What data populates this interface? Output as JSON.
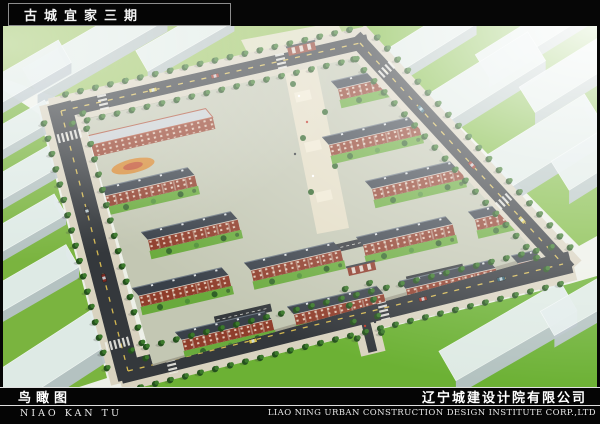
{
  "frame": {
    "title": "古城宜家三期"
  },
  "footer": {
    "caption_cn": "鸟瞰图",
    "caption_pinyin": "NIAO KAN TU",
    "company_cn": "辽宁城建设计院有限公司",
    "company_en": "LIAO NING URBAN CONSTRUCTION DESIGN INSTITUTE CORP.,LTD"
  },
  "scene": {
    "colors": {
      "base": "#edf0e8",
      "road": "#34383c",
      "sidewalk": "#d9d3c0",
      "dash": "#d4b851",
      "site": "#c3c7b3",
      "brick": "#8f3d2b",
      "roof": "#394049",
      "yard": "#69aa3c",
      "block_top": "#e3edec",
      "block_front": "#b7c3c8",
      "block_end": "#a7b3b8",
      "grass_bright": "#7db93e",
      "plaza": "#e5ddc5"
    },
    "ring": {
      "edges": [
        {
          "p1": [
            58,
            85
          ],
          "p2": [
            357,
            17
          ],
          "w": 14
        },
        {
          "p1": [
            357,
            17
          ],
          "p2": [
            560,
            238
          ],
          "w": 16
        },
        {
          "p1": [
            125,
            345
          ],
          "p2": [
            560,
            238
          ],
          "w": 22
        },
        {
          "p1": [
            58,
            85
          ],
          "p2": [
            125,
            345
          ],
          "w": 24
        },
        {
          "p1": [
            352,
            252
          ],
          "p2": [
            368,
            318
          ],
          "w": 9
        }
      ]
    },
    "site_clip": [
      [
        81,
        93
      ],
      [
        350,
        32
      ],
      [
        538,
        232
      ],
      [
        150,
        340
      ]
    ],
    "grass": [
      {
        "pts": [
          [
            0,
            0
          ],
          [
            352,
            0
          ],
          [
            354,
            4
          ],
          [
            55,
            72
          ],
          [
            0,
            52
          ]
        ],
        "fill": "#9cc463"
      },
      {
        "pts": [
          [
            344,
            0
          ],
          [
            594,
            0
          ],
          [
            594,
            210
          ],
          [
            576,
            220
          ],
          [
            368,
            10
          ]
        ],
        "fill": "#7db93e"
      },
      {
        "pts": [
          [
            0,
            64
          ],
          [
            36,
            88
          ],
          [
            104,
            352
          ],
          [
            70,
            363
          ],
          [
            0,
            363
          ]
        ],
        "fill": "#7ab43f"
      },
      {
        "pts": [
          [
            128,
            363
          ],
          [
            566,
            258
          ],
          [
            594,
            250
          ],
          [
            594,
            363
          ]
        ],
        "fill": "#6cb134"
      }
    ],
    "entry_pavement": [
      [
        238,
        14
      ],
      [
        334,
        -4
      ],
      [
        344,
        16
      ],
      [
        252,
        42
      ]
    ],
    "plaza_quad": [
      [
        279,
        33
      ],
      [
        311,
        27
      ],
      [
        346,
        202
      ],
      [
        314,
        208
      ]
    ],
    "blocks": [
      {
        "x": 92,
        "y": 18,
        "l": 150,
        "w": 30,
        "a": -30,
        "h": 12
      },
      {
        "x": 182,
        "y": 10,
        "l": 100,
        "w": 24,
        "a": -30,
        "h": 10
      },
      {
        "x": 12,
        "y": 54,
        "l": 115,
        "w": 26,
        "a": -30,
        "h": 11
      },
      {
        "x": 8,
        "y": 106,
        "l": 90,
        "w": 22,
        "a": -30,
        "h": 10
      },
      {
        "x": 420,
        "y": 16,
        "l": 110,
        "w": 26,
        "a": -32,
        "h": 11
      },
      {
        "x": 530,
        "y": 8,
        "l": 120,
        "w": 26,
        "a": -32,
        "h": 11
      },
      {
        "x": 470,
        "y": 60,
        "l": 150,
        "w": 34,
        "a": -32,
        "h": 14
      },
      {
        "x": 575,
        "y": 42,
        "l": 120,
        "w": 30,
        "a": -32,
        "h": 12
      },
      {
        "x": 520,
        "y": 130,
        "l": 170,
        "w": 40,
        "a": -32,
        "h": 16
      },
      {
        "x": 608,
        "y": 118,
        "l": 120,
        "w": 34,
        "a": -32,
        "h": 14
      },
      {
        "x": 20,
        "y": 148,
        "l": 90,
        "w": 24,
        "a": -30,
        "h": 10
      },
      {
        "x": 16,
        "y": 202,
        "l": 95,
        "w": 24,
        "a": -30,
        "h": 10
      },
      {
        "x": 24,
        "y": 256,
        "l": 105,
        "w": 26,
        "a": -30,
        "h": 11
      },
      {
        "x": 46,
        "y": 334,
        "l": 140,
        "w": 38,
        "a": -33,
        "h": 17
      },
      {
        "x": 505,
        "y": 305,
        "l": 140,
        "w": 34,
        "a": -30,
        "h": 15
      },
      {
        "x": 592,
        "y": 270,
        "l": 110,
        "w": 28,
        "a": -30,
        "h": 12
      }
    ],
    "grid": {
      "origin": [
        68,
        70
      ],
      "col": [
        112,
        -25.5
      ],
      "row": [
        17,
        50
      ],
      "stagger": [
        26,
        -6
      ],
      "rows": 7,
      "cols": 5,
      "len": 92,
      "angle": -13,
      "skip": [
        [
          1,
          0
        ]
      ],
      "plaza_zone": {
        "x1": 253,
        "x2": 352,
        "y_max": 212
      }
    },
    "parking": [
      {
        "x": 352,
        "y": 218
      },
      {
        "x": 432,
        "y": 248
      },
      {
        "x": 240,
        "y": 288
      }
    ],
    "crosswalks": [
      {
        "x": 100,
        "y": 76,
        "a": -12.8,
        "w": 15
      },
      {
        "x": 278,
        "y": 35,
        "a": -12.8,
        "w": 15
      },
      {
        "x": 66,
        "y": 110,
        "a": 75.6,
        "w": 25
      },
      {
        "x": 114,
        "y": 318,
        "a": 75.6,
        "w": 25
      },
      {
        "x": 168,
        "y": 336,
        "a": -13.8,
        "w": 23
      },
      {
        "x": 380,
        "y": 282,
        "a": -13.8,
        "w": 23
      },
      {
        "x": 383,
        "y": 44,
        "a": 47.4,
        "w": 17
      },
      {
        "x": 500,
        "y": 176,
        "a": 47.4,
        "w": 17
      }
    ],
    "cars": [
      {
        "x": 212,
        "y": 50,
        "a": -12.8,
        "c": "#a23326"
      },
      {
        "x": 150,
        "y": 64,
        "a": -12.8,
        "c": "#d9c34a"
      },
      {
        "x": 418,
        "y": 83,
        "a": 47.4,
        "c": "#3a6d7d"
      },
      {
        "x": 469,
        "y": 139,
        "a": 47.4,
        "c": "#a23326"
      },
      {
        "x": 519,
        "y": 194,
        "a": 47.4,
        "c": "#d9c34a"
      },
      {
        "x": 250,
        "y": 315,
        "a": -13.8,
        "c": "#d9c34a"
      },
      {
        "x": 420,
        "y": 273,
        "a": -13.8,
        "c": "#a23326"
      },
      {
        "x": 498,
        "y": 253,
        "a": -13.8,
        "c": "#2c5a68"
      },
      {
        "x": 84,
        "y": 185,
        "a": 75.6,
        "c": "#33373b"
      },
      {
        "x": 101,
        "y": 252,
        "a": 75.6,
        "c": "#7e2a22"
      }
    ],
    "people": [
      [
        296,
        70
      ],
      [
        304,
        96
      ],
      [
        292,
        128
      ],
      [
        310,
        150
      ],
      [
        362,
        300
      ],
      [
        372,
        296
      ]
    ],
    "gates": [
      {
        "x": 286,
        "y": 30,
        "a": -13
      },
      {
        "x": 346,
        "y": 250,
        "a": -13
      }
    ],
    "commercial": {
      "x": 85,
      "y": 120,
      "len": 128
    },
    "playground": {
      "x": 130,
      "y": 140
    }
  }
}
